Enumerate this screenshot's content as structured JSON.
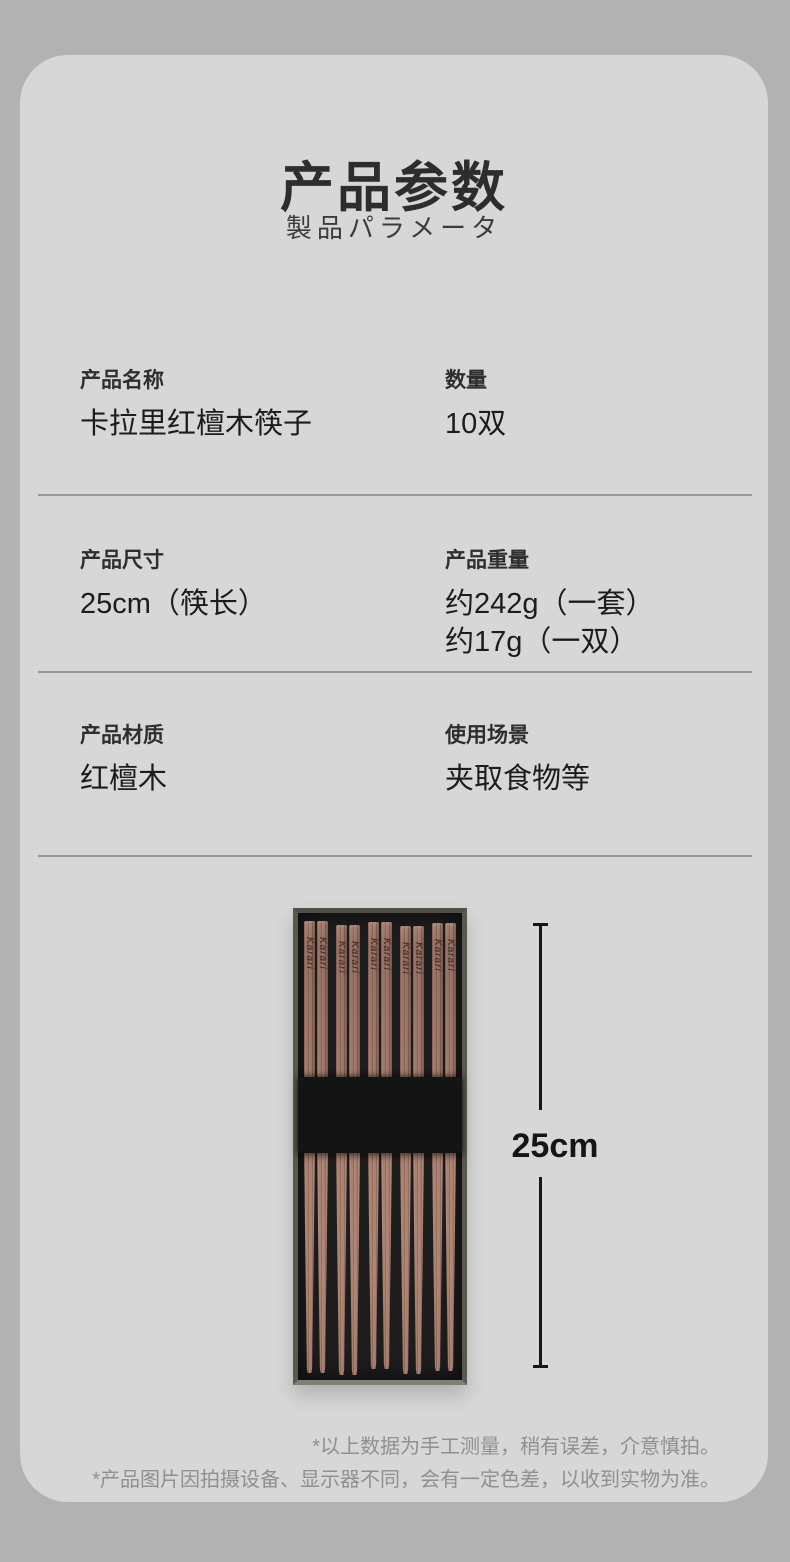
{
  "page": {
    "background_color": "#b2b2b2",
    "card_color": "#d7d7d7",
    "divider_color": "#999999",
    "text_color": "#1c1c1c"
  },
  "header": {
    "title": "产品参数",
    "subtitle": "製品パラメータ"
  },
  "specs": [
    {
      "cells": [
        {
          "label": "产品名称",
          "values": [
            "卡拉里红檀木筷子"
          ]
        },
        {
          "label": "数量",
          "values": [
            "10双"
          ]
        }
      ]
    },
    {
      "cells": [
        {
          "label": "产品尺寸",
          "values": [
            "25cm（筷长）"
          ]
        },
        {
          "label": "产品重量",
          "values": [
            "约242g（一套）",
            "约17g（一双）"
          ]
        }
      ]
    },
    {
      "cells": [
        {
          "label": "产品材质",
          "values": [
            "红檀木"
          ]
        },
        {
          "label": "使用场景",
          "values": [
            "夹取食物等"
          ]
        }
      ]
    }
  ],
  "figure": {
    "brand_text": "Karari",
    "dimension_label": "25cm",
    "pairs_count": 5,
    "wood_color": "#9c7365",
    "box_color": "#1d1d1d"
  },
  "footer": {
    "notes": [
      "*以上数据为手工测量，稍有误差，介意慎拍。",
      "*产品图片因拍摄设备、显示器不同，会有一定色差，以收到实物为准。"
    ]
  }
}
